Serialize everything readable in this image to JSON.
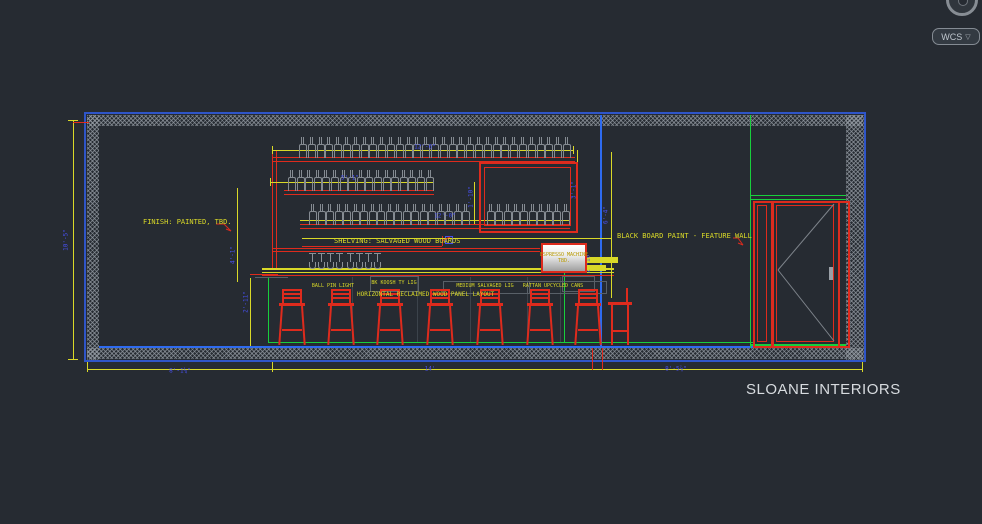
{
  "header": {
    "wcs_label": "WCS",
    "wcs_chevron": "▽"
  },
  "branding": {
    "title": "SLOANE INTERIORS"
  },
  "notes": {
    "finish": "FINISH: PAINTED, TBD.",
    "shelving": "SHELVING: SALVAGED WOOD BOARDS",
    "blackboard": "BLACK BOARD PAINT - FEATURE WALL",
    "panel_layout": "HORIZONTAL RECLAIMED WOOD PANEL LAYOUT",
    "machine1": "ESPRESSO MACHINE",
    "machine2": "TBD.",
    "keynotes": [
      {
        "t": "BALL PIN LIGHT",
        "x": 333,
        "y": 286
      },
      {
        "t": "BK KOOSH TY LIG",
        "x": 394,
        "y": 283
      },
      {
        "t": "MEDIUM SALVAGED LIG",
        "x": 485,
        "y": 286
      },
      {
        "t": "RATTAN UPCYCLED CANS",
        "x": 553,
        "y": 286
      }
    ]
  },
  "dimensions": [
    {
      "t": "12'-6\"",
      "x": 425,
      "y": 147,
      "rot": 0
    },
    {
      "t": "5'-1\"",
      "x": 350,
      "y": 178,
      "rot": 0
    },
    {
      "t": "12'-0\"",
      "x": 445,
      "y": 216,
      "rot": 0
    },
    {
      "t": "1'-10\"",
      "x": 471,
      "y": 197,
      "rot": 90
    },
    {
      "t": "3'-1\"",
      "x": 574,
      "y": 190,
      "rot": 90
    },
    {
      "t": "6'-4\"",
      "x": 606,
      "y": 215,
      "rot": 90
    },
    {
      "t": "2'-10\"",
      "x": 588,
      "y": 262,
      "rot": 90
    },
    {
      "t": "10'-5\"",
      "x": 66,
      "y": 240,
      "rot": 90
    },
    {
      "t": "4'-1\"",
      "x": 233,
      "y": 255,
      "rot": 90
    },
    {
      "t": "2'-11\"",
      "x": 246,
      "y": 302,
      "rot": 90
    },
    {
      "t": "8'-1¼\"",
      "x": 180,
      "y": 371,
      "rot": 0
    },
    {
      "t": "14'",
      "x": 430,
      "y": 369,
      "rot": 0
    },
    {
      "t": "8'-5⅞\"",
      "x": 676,
      "y": 369,
      "rot": 0
    }
  ],
  "colors": {
    "wallblue": "#2f55c8",
    "blue": "#2e6bf0",
    "red": "#de2b1d",
    "yellow": "#d9d928",
    "green": "#18cf3c",
    "grayline": "#596068",
    "graylight": "#9aa0a7",
    "panelline": "#3c434b",
    "dimblue": "#4750ee",
    "doorgray": "#7e848b",
    "background": "#262b32"
  },
  "drawing": {
    "lines": [
      {
        "x": 84,
        "y": 112,
        "w": 782,
        "h": 2,
        "c": "wallblue"
      },
      {
        "x": 84,
        "y": 360,
        "w": 782,
        "h": 2,
        "c": "wallblue"
      },
      {
        "x": 84,
        "y": 112,
        "w": 2,
        "h": 250,
        "c": "wallblue"
      },
      {
        "x": 864,
        "y": 112,
        "w": 2,
        "h": 250,
        "c": "wallblue"
      },
      {
        "x": 87,
        "y": 115,
        "w": 776,
        "h": 11,
        "c": "hatch"
      },
      {
        "x": 87,
        "y": 115,
        "w": 12,
        "h": 245,
        "c": "hatch"
      },
      {
        "x": 846,
        "y": 115,
        "w": 18,
        "h": 245,
        "c": "hatch"
      },
      {
        "x": 87,
        "y": 348,
        "w": 776,
        "h": 11,
        "c": "hatch"
      },
      {
        "x": 99,
        "y": 346,
        "w": 748,
        "h": 2,
        "c": "blue"
      },
      {
        "x": 600,
        "y": 115,
        "w": 2,
        "h": 232,
        "c": "blue"
      },
      {
        "x": 268,
        "y": 277,
        "w": 1,
        "h": 66,
        "c": "green"
      },
      {
        "x": 268,
        "y": 342,
        "w": 485,
        "h": 1,
        "c": "green"
      },
      {
        "x": 564,
        "y": 257,
        "w": 1,
        "h": 86,
        "c": "green"
      },
      {
        "x": 750,
        "y": 115,
        "w": 1,
        "h": 233,
        "c": "green"
      },
      {
        "x": 750,
        "y": 195,
        "w": 96,
        "h": 1,
        "c": "green"
      },
      {
        "x": 750,
        "y": 199,
        "w": 96,
        "h": 1,
        "c": "green"
      },
      {
        "x": 750,
        "y": 344,
        "w": 96,
        "h": 2,
        "c": "green"
      },
      {
        "x": 272,
        "y": 157,
        "w": 303,
        "h": 1,
        "c": "red"
      },
      {
        "x": 272,
        "y": 161,
        "w": 303,
        "h": 1,
        "c": "red"
      },
      {
        "x": 284,
        "y": 190,
        "w": 150,
        "h": 1,
        "c": "red"
      },
      {
        "x": 284,
        "y": 194,
        "w": 150,
        "h": 1,
        "c": "red"
      },
      {
        "x": 300,
        "y": 224,
        "w": 270,
        "h": 1,
        "c": "red"
      },
      {
        "x": 300,
        "y": 228,
        "w": 270,
        "h": 1,
        "c": "red"
      },
      {
        "x": 272,
        "y": 151,
        "w": 1,
        "h": 119,
        "c": "red"
      },
      {
        "x": 276,
        "y": 151,
        "w": 1,
        "h": 119,
        "c": "red"
      },
      {
        "x": 272,
        "y": 248,
        "w": 268,
        "h": 1,
        "c": "red"
      },
      {
        "x": 272,
        "y": 251,
        "w": 268,
        "h": 1,
        "c": "red"
      },
      {
        "x": 302,
        "y": 246,
        "w": 140,
        "h": 1,
        "c": "red"
      },
      {
        "x": 442,
        "y": 236,
        "w": 1,
        "h": 10,
        "c": "red"
      },
      {
        "x": 262,
        "y": 275,
        "w": 352,
        "h": 1,
        "c": "red"
      },
      {
        "x": 272,
        "y": 150,
        "w": 302,
        "h": 1,
        "c": "yellow"
      },
      {
        "x": 272,
        "y": 146,
        "w": 1,
        "h": 8,
        "c": "yellow"
      },
      {
        "x": 573,
        "y": 146,
        "w": 1,
        "h": 8,
        "c": "yellow"
      },
      {
        "x": 270,
        "y": 182,
        "w": 164,
        "h": 1,
        "c": "yellow"
      },
      {
        "x": 270,
        "y": 178,
        "w": 1,
        "h": 8,
        "c": "yellow"
      },
      {
        "x": 433,
        "y": 178,
        "w": 1,
        "h": 8,
        "c": "yellow"
      },
      {
        "x": 300,
        "y": 220,
        "w": 270,
        "h": 1,
        "c": "yellow"
      },
      {
        "x": 302,
        "y": 238,
        "w": 310,
        "h": 1,
        "c": "yellow"
      },
      {
        "x": 262,
        "y": 268,
        "w": 352,
        "h": 2,
        "c": "yellow"
      },
      {
        "x": 262,
        "y": 272,
        "w": 352,
        "h": 1,
        "c": "yellow"
      },
      {
        "x": 237,
        "y": 188,
        "w": 1,
        "h": 94,
        "c": "yellow"
      },
      {
        "x": 250,
        "y": 278,
        "w": 1,
        "h": 68,
        "c": "yellow"
      },
      {
        "x": 73,
        "y": 120,
        "w": 1,
        "h": 240,
        "c": "yellow"
      },
      {
        "x": 68,
        "y": 120,
        "w": 10,
        "h": 1,
        "c": "yellow"
      },
      {
        "x": 68,
        "y": 359,
        "w": 10,
        "h": 1,
        "c": "yellow"
      },
      {
        "x": 474,
        "y": 182,
        "w": 1,
        "h": 42,
        "c": "yellow"
      },
      {
        "x": 577,
        "y": 150,
        "w": 1,
        "h": 78,
        "c": "yellow"
      },
      {
        "x": 611,
        "y": 152,
        "w": 1,
        "h": 146,
        "c": "yellow"
      },
      {
        "x": 87,
        "y": 369,
        "w": 776,
        "h": 1,
        "c": "yellow"
      },
      {
        "x": 87,
        "y": 362,
        "w": 1,
        "h": 10,
        "c": "yellow"
      },
      {
        "x": 272,
        "y": 362,
        "w": 1,
        "h": 10,
        "c": "yellow"
      },
      {
        "x": 862,
        "y": 362,
        "w": 1,
        "h": 10,
        "c": "yellow"
      },
      {
        "x": 592,
        "y": 348,
        "w": 1,
        "h": 22,
        "c": "red"
      },
      {
        "x": 602,
        "y": 348,
        "w": 1,
        "h": 22,
        "c": "red"
      },
      {
        "x": 73,
        "y": 122,
        "w": 16,
        "h": 1,
        "c": "red"
      },
      {
        "x": 250,
        "y": 274,
        "w": 28,
        "h": 1,
        "c": "red"
      },
      {
        "x": 585,
        "y": 257,
        "w": 33,
        "h": 6,
        "c": "yellow"
      },
      {
        "x": 583,
        "y": 265,
        "w": 23,
        "h": 6,
        "c": "yellow"
      },
      {
        "x": 255,
        "y": 277,
        "w": 33,
        "h": 1,
        "c": "grayline"
      },
      {
        "x": 829,
        "y": 267,
        "w": 4,
        "h": 13,
        "c": "graylight"
      },
      {
        "x": 352,
        "y": 277,
        "w": 1,
        "h": 65,
        "c": "panelline"
      },
      {
        "x": 417,
        "y": 277,
        "w": 1,
        "h": 65,
        "c": "panelline"
      },
      {
        "x": 470,
        "y": 277,
        "w": 1,
        "h": 65,
        "c": "panelline"
      },
      {
        "x": 527,
        "y": 277,
        "w": 1,
        "h": 65,
        "c": "panelline"
      },
      {
        "x": 560,
        "y": 277,
        "w": 1,
        "h": 65,
        "c": "panelline"
      }
    ],
    "boxes": [
      {
        "x": 479,
        "y": 162,
        "w": 95,
        "h": 67,
        "c": "red",
        "b": 2
      },
      {
        "x": 484,
        "y": 167,
        "w": 85,
        "h": 57,
        "c": "red",
        "b": 1
      },
      {
        "x": 753,
        "y": 201,
        "w": 16,
        "h": 143,
        "c": "red",
        "b": 2
      },
      {
        "x": 757,
        "y": 205,
        "w": 8,
        "h": 135,
        "c": "red",
        "b": 1
      },
      {
        "x": 772,
        "y": 201,
        "w": 64,
        "h": 143,
        "c": "red",
        "b": 2
      },
      {
        "x": 776,
        "y": 205,
        "w": 56,
        "h": 135,
        "c": "red",
        "b": 1
      },
      {
        "x": 838,
        "y": 201,
        "w": 8,
        "h": 143,
        "c": "red",
        "b": 2
      },
      {
        "x": 562,
        "y": 276,
        "w": 31,
        "h": 14,
        "c": "grayline",
        "b": 1
      },
      {
        "x": 370,
        "y": 276,
        "w": 47,
        "h": 14,
        "c": "grayline",
        "b": 1
      },
      {
        "x": 443,
        "y": 281,
        "w": 85,
        "h": 11,
        "c": "grayline",
        "b": 1
      },
      {
        "x": 527,
        "y": 281,
        "w": 78,
        "h": 11,
        "c": "grayline",
        "b": 1
      },
      {
        "x": 445,
        "y": 236,
        "w": 6,
        "h": 6,
        "c": "dimblue",
        "b": 1
      }
    ],
    "bottle_rows": [
      {
        "x": 299,
        "y": 157,
        "count": 31,
        "gap": 8.8
      },
      {
        "x": 288,
        "y": 190,
        "count": 17,
        "gap": 8.6
      },
      {
        "x": 309,
        "y": 224,
        "count": 19,
        "gap": 8.5
      },
      {
        "x": 487,
        "y": 224,
        "count": 10,
        "gap": 8.3
      }
    ],
    "glass_groups": [
      {
        "x": 309,
        "y": 253,
        "count": 4,
        "gap": 9
      },
      {
        "x": 347,
        "y": 253,
        "count": 4,
        "gap": 9
      }
    ],
    "stools": [
      {
        "x": 279
      },
      {
        "x": 328
      },
      {
        "x": 377
      },
      {
        "x": 427
      },
      {
        "x": 477
      },
      {
        "x": 527
      },
      {
        "x": 575
      }
    ],
    "chair": {
      "x": 608,
      "y": 288
    },
    "svg_lines": [
      {
        "x1": 834,
        "y1": 204,
        "x2": 778,
        "y2": 270,
        "c": "doorgray"
      },
      {
        "x1": 778,
        "y1": 270,
        "x2": 834,
        "y2": 341,
        "c": "doorgray"
      },
      {
        "x1": 216,
        "y1": 224,
        "x2": 224,
        "y2": 224,
        "c": "red"
      },
      {
        "x1": 224,
        "y1": 224,
        "x2": 231,
        "y2": 231,
        "c": "red"
      },
      {
        "x1": 231,
        "y1": 231,
        "x2": 226,
        "y2": 229,
        "c": "red"
      },
      {
        "x1": 733,
        "y1": 238,
        "x2": 738,
        "y2": 238,
        "c": "red"
      },
      {
        "x1": 738,
        "y1": 238,
        "x2": 743,
        "y2": 245,
        "c": "red"
      },
      {
        "x1": 743,
        "y1": 245,
        "x2": 738,
        "y2": 243,
        "c": "red"
      },
      {
        "x1": 442,
        "y1": 241,
        "x2": 450,
        "y2": 237,
        "c": "red"
      }
    ]
  }
}
